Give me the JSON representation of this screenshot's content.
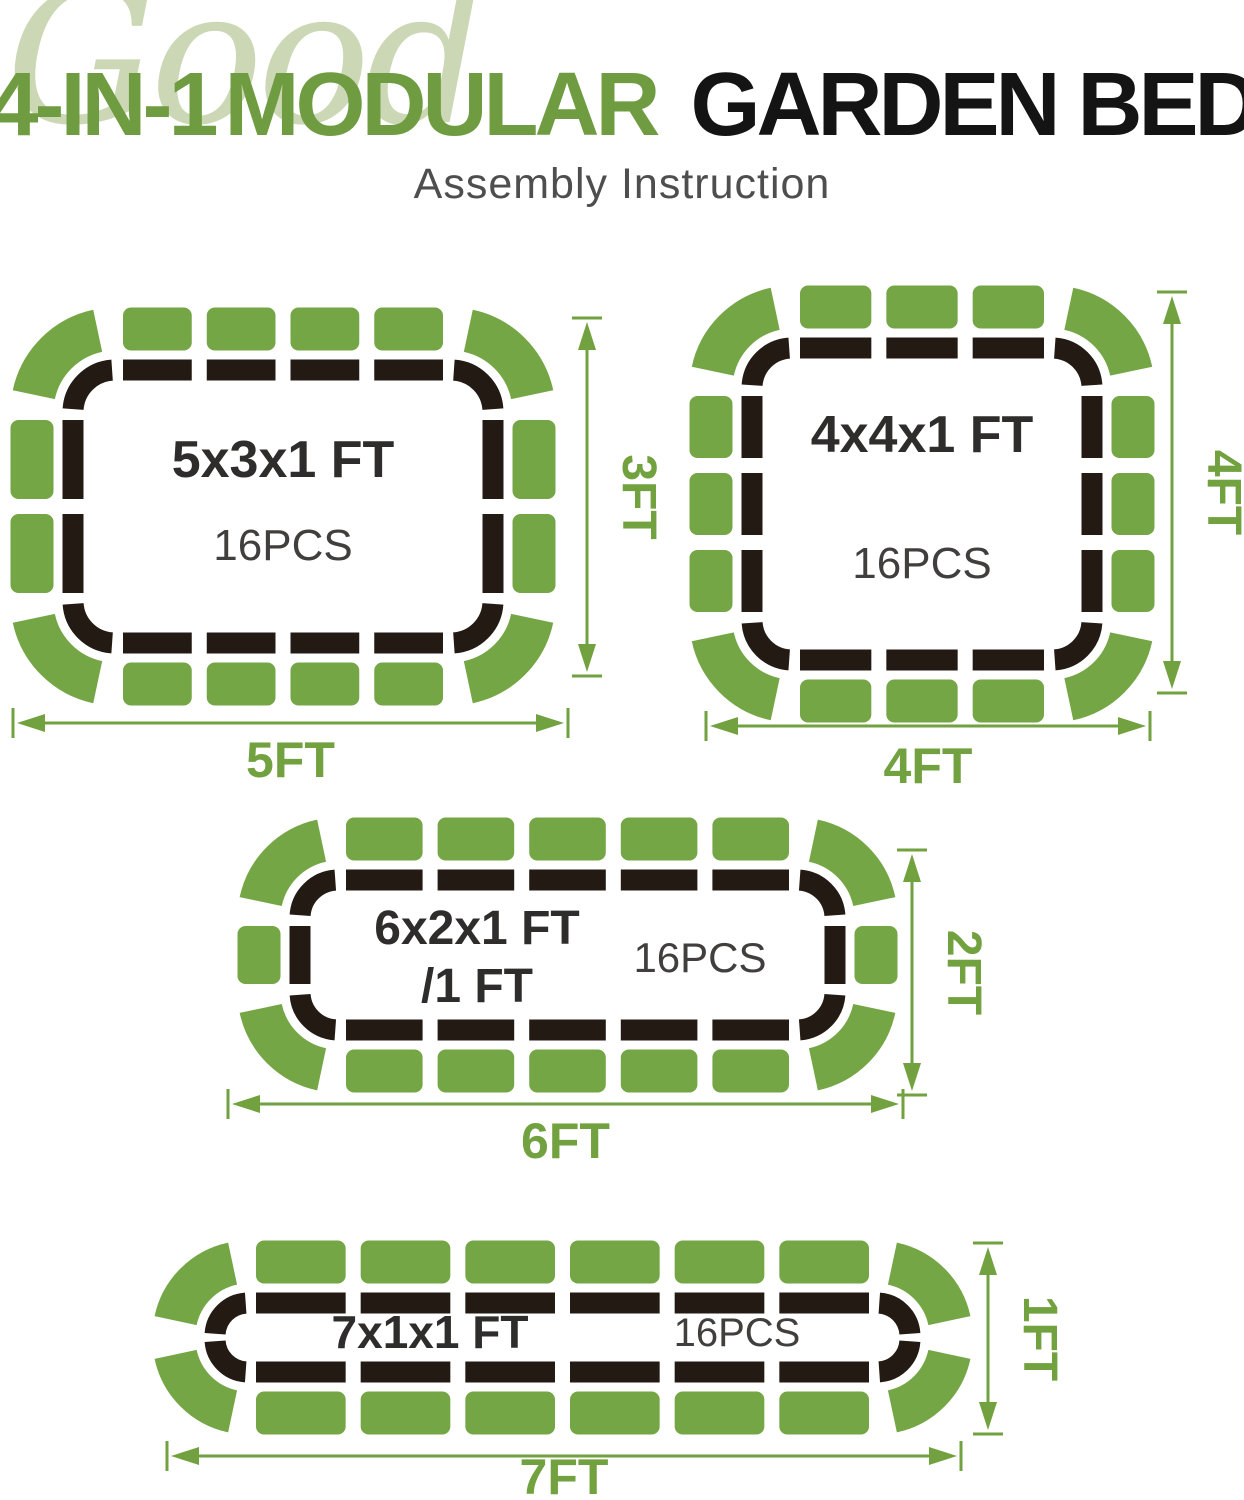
{
  "header": {
    "watermark": "Good",
    "title": {
      "part1": "4-IN-1",
      "part2": "MODULAR",
      "part3": "GARDEN BED"
    },
    "subtitle": "Assembly Instruction"
  },
  "colors": {
    "brand_green": "#6f9c41",
    "panel_green": "#75a645",
    "dim_green": "#72a13f",
    "watermark_green": "#ccd8b5",
    "dash_black": "#241a14",
    "title_black": "#141414",
    "subtitle_gray": "#4f4e4e",
    "size_label_dark": "#2f2d2b",
    "pcs_label_dark": "#413f3e"
  },
  "beds": [
    {
      "name": "5x3x1 ft configuration",
      "size_label": "5x3x1 FT",
      "pieces_label": "16PCS",
      "width_label": "5FT",
      "height_label": "3FT",
      "panels": {
        "top": 4,
        "bottom": 4,
        "left": 2,
        "right": 2,
        "corner": 4
      },
      "total_pieces": 16
    },
    {
      "name": "4x4x1 ft configuration",
      "size_label": "4x4x1 FT",
      "pieces_label": "16PCS",
      "width_label": "4FT",
      "height_label": "4FT",
      "panels": {
        "top": 3,
        "bottom": 3,
        "left": 3,
        "right": 3,
        "corner": 4
      },
      "total_pieces": 16
    },
    {
      "name": "6x2x1 ft configuration",
      "size_label": "6x2x1 FT",
      "size_label_line2": "/1 FT",
      "pieces_label": "16PCS",
      "width_label": "6FT",
      "height_label": "2FT",
      "panels": {
        "top": 5,
        "bottom": 5,
        "left": 1,
        "right": 1,
        "corner": 4
      },
      "total_pieces": 16
    },
    {
      "name": "7x1x1 ft configuration",
      "size_label": "7x1x1 FT",
      "pieces_label": "16PCS",
      "width_label": "7FT",
      "height_label": "1FT",
      "panels": {
        "top": 6,
        "bottom": 6,
        "left": 0,
        "right": 0,
        "corner": 4
      },
      "total_pieces": 16
    }
  ]
}
